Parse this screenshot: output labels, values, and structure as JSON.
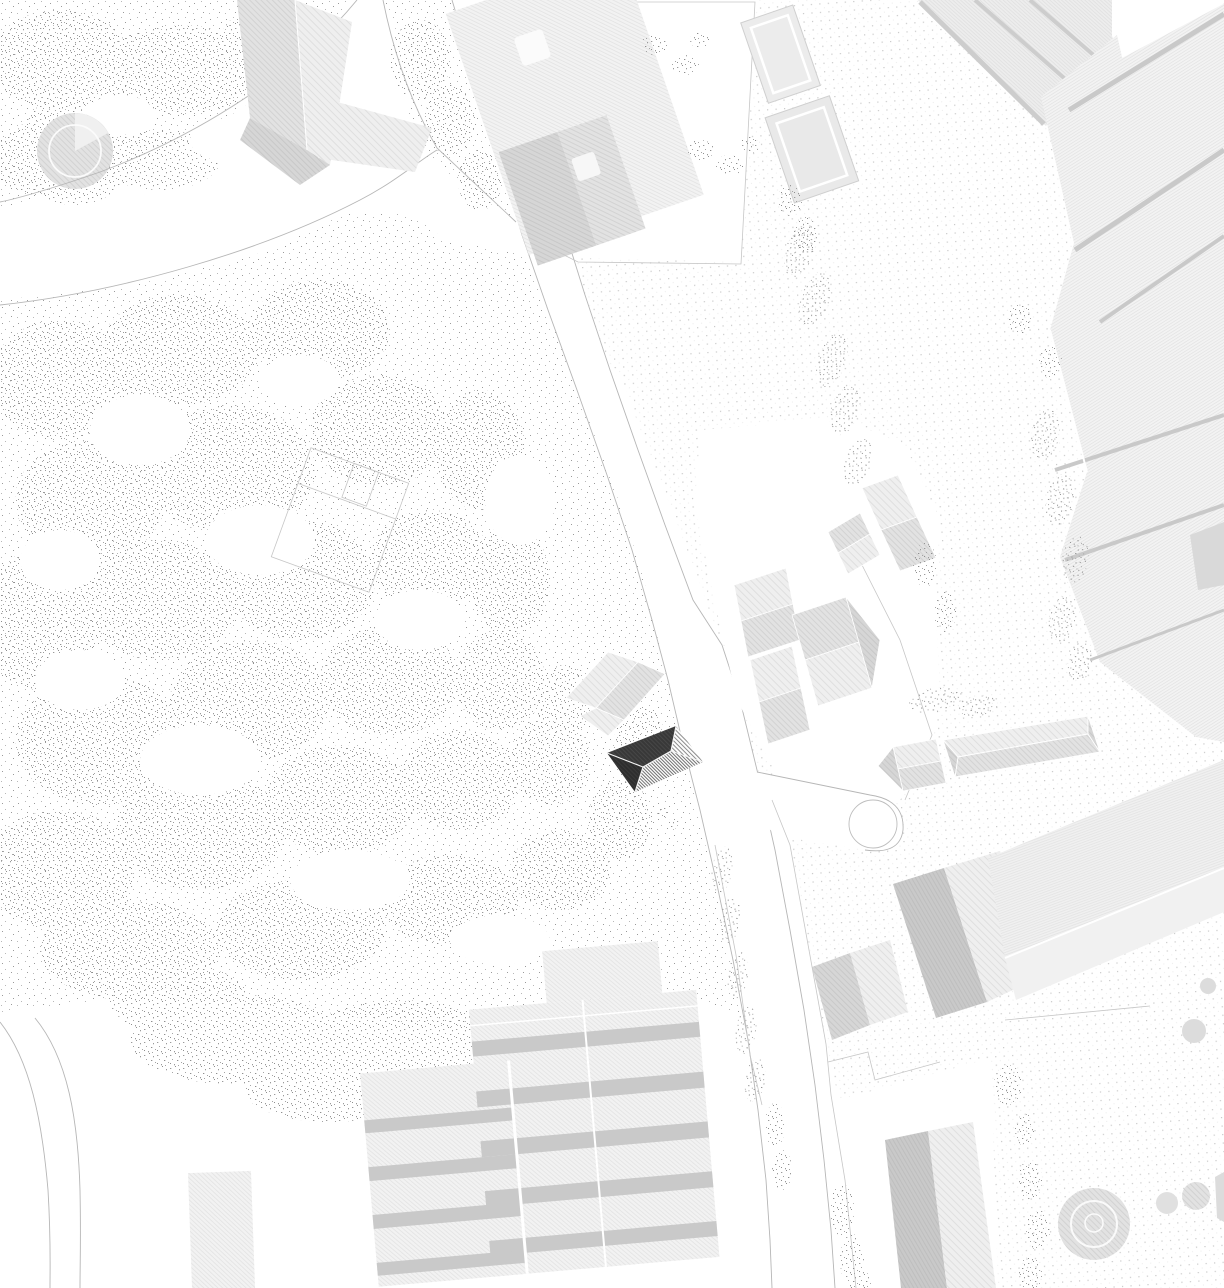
{
  "document": {
    "type": "architectural-site-plan",
    "title": "Black-and-white architectural site plan with highlighted project building",
    "visible_text": []
  },
  "palette": {
    "background": "#ffffff",
    "white": "#ffffff",
    "drawing_line": "#b6b6b6",
    "parcel_line": "#c6c6c6",
    "stipple_dot": "#9a9a9a",
    "stipple_dot_light": "#b8b8b8",
    "dot_grid_dot": "#c8c8c8",
    "roof_light": "#efefef",
    "roof_light_line": "#dfdfdf",
    "roof_mid": "#e2e2e2",
    "roof_mid_line": "#d2d2d2",
    "roof_shade": "#d6d6d6",
    "roof_shade_line": "#c8c8c8",
    "roof_band_dark": "#c9c9c9",
    "rib_bg": "#f3f3f3",
    "rib_line": "#e4e4e4",
    "project_dark": "#383838",
    "project_dark_line": "#4a4a4a",
    "project_shade_line": "#707070"
  },
  "map": {
    "orientation": "plan view, no labels",
    "features": [
      {
        "name": "park-west",
        "kind": "vegetated park with stipple texture"
      },
      {
        "name": "round-garden-feature",
        "kind": "circular planted element with inner ring"
      },
      {
        "name": "garden-square",
        "kind": "rotated square enclosure outline"
      },
      {
        "name": "villa-northwest",
        "kind": "hip-roof building"
      },
      {
        "name": "north-parcel-building",
        "kind": "large roof with dark wing and skylights"
      },
      {
        "name": "courtyard-buildings-north",
        "kind": "two outlined small buildings"
      },
      {
        "name": "main-street",
        "kind": "curved street running north-south"
      },
      {
        "name": "west-path",
        "kind": "park path branching to the west"
      },
      {
        "name": "southwest-road",
        "kind": "narrow road at lower left"
      },
      {
        "name": "dot-paved-field-east",
        "kind": "regular dot-grid ground"
      },
      {
        "name": "project-building",
        "kind": "highlighted dark hip-roof building"
      },
      {
        "name": "neighbor-building",
        "kind": "light roof north of project building"
      },
      {
        "name": "hip-roof-cluster-east",
        "kind": "group of hip-roof houses"
      },
      {
        "name": "long-hip-building",
        "kind": "elongated hip-roof building"
      },
      {
        "name": "gable-outbuilding",
        "kind": "small gabled building"
      },
      {
        "name": "cul-de-sac",
        "kind": "turning circle on access path"
      },
      {
        "name": "sheds-northeast",
        "kind": "ribbed industrial sheds"
      },
      {
        "name": "industrial-complex-east",
        "kind": "large ribbed roof complex"
      },
      {
        "name": "slab-buildings-southeast",
        "kind": "parallel slab blocks"
      },
      {
        "name": "slab-buildings-south",
        "kind": "two vertical slab blocks"
      },
      {
        "name": "terraced-building-south",
        "kind": "stepped blocks with banded roofs"
      },
      {
        "name": "outbuilding-southwest",
        "kind": "small hatched building"
      },
      {
        "name": "circular-plaza-southeast",
        "kind": "hatched disc with concentric rings"
      },
      {
        "name": "hedges",
        "kind": "stippled hedge strips"
      },
      {
        "name": "tree-clumps",
        "kind": "stippled canopies"
      }
    ]
  }
}
